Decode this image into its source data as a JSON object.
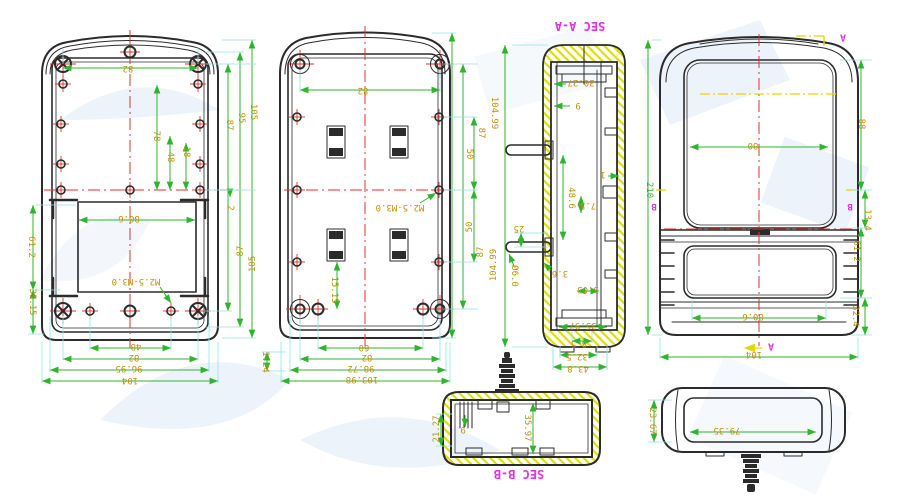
{
  "drawing_type": "enclosure-engineering-drawing",
  "palette": {
    "ink": "#2b2b2b",
    "dim_line": "#2eb42e",
    "dimension_text": "#c2900a",
    "extension": "#93e2e2",
    "centerline": "#e03328",
    "section_label": "#e431e4",
    "hatch": "#e0de00",
    "section_line": "#e8d400",
    "background": "#ffffff",
    "watermark": "#e9f1f9"
  },
  "annotations": [
    {
      "view": "back-panel",
      "text": "82",
      "x": 128,
      "y": 68,
      "rot": 180
    },
    {
      "view": "back-panel",
      "text": "78",
      "x": 156,
      "y": 136,
      "rot": 90
    },
    {
      "view": "back-panel",
      "text": "48",
      "x": 170,
      "y": 157,
      "rot": 90
    },
    {
      "view": "back-panel",
      "text": "18",
      "x": 186,
      "y": 152,
      "rot": 90
    },
    {
      "view": "back-panel",
      "text": "87",
      "x": 229,
      "y": 125,
      "rot": 90
    },
    {
      "view": "back-panel",
      "text": "95",
      "x": 241,
      "y": 118,
      "rot": 90
    },
    {
      "view": "back-panel",
      "text": "105",
      "x": 253,
      "y": 112,
      "rot": 90
    },
    {
      "view": "back-panel",
      "text": "2",
      "x": 230,
      "y": 208,
      "rot": 90
    },
    {
      "view": "back-panel",
      "text": "87",
      "x": 241,
      "y": 251,
      "rot": -90
    },
    {
      "view": "back-panel",
      "text": "105",
      "x": 253,
      "y": 264,
      "rot": -90
    },
    {
      "view": "back-panel",
      "text": "61.2",
      "x": 31,
      "y": 247,
      "rot": 90
    },
    {
      "view": "back-panel",
      "text": "31.15",
      "x": 32,
      "y": 302,
      "rot": 90
    },
    {
      "view": "back-panel",
      "text": "80.6",
      "x": 129,
      "y": 218,
      "rot": 180
    },
    {
      "view": "back-panel",
      "text": "M2.5-M3.0",
      "x": 136,
      "y": 281,
      "rot": 180
    },
    {
      "view": "back-panel",
      "text": "48",
      "x": 136,
      "y": 346,
      "rot": 180
    },
    {
      "view": "back-panel",
      "text": "82",
      "x": 134,
      "y": 357,
      "rot": 180
    },
    {
      "view": "back-panel",
      "text": "96.95",
      "x": 129,
      "y": 368,
      "rot": 180
    },
    {
      "view": "back-panel",
      "text": "104",
      "x": 130,
      "y": 380,
      "rot": 180
    },
    {
      "view": "base-panel",
      "text": "82",
      "x": 363,
      "y": 90,
      "rot": 180
    },
    {
      "view": "base-panel",
      "text": "15.15",
      "x": 334,
      "y": 290,
      "rot": 90
    },
    {
      "view": "base-panel",
      "text": "M2.5-M3.0",
      "x": 400,
      "y": 207,
      "rot": 180
    },
    {
      "view": "base-panel",
      "text": "60",
      "x": 364,
      "y": 347,
      "rot": 180
    },
    {
      "view": "base-panel",
      "text": "82",
      "x": 367,
      "y": 357,
      "rot": 180
    },
    {
      "view": "base-panel",
      "text": "98.72",
      "x": 361,
      "y": 368,
      "rot": 180
    },
    {
      "view": "base-panel",
      "text": "103.98",
      "x": 362,
      "y": 379,
      "rot": 180
    },
    {
      "view": "base-panel",
      "text": "1.24",
      "x": 265,
      "y": 362,
      "rot": 90
    },
    {
      "view": "base-panel",
      "text": "104.99",
      "x": 494,
      "y": 113,
      "rot": 90
    },
    {
      "view": "base-panel",
      "text": "87",
      "x": 481,
      "y": 133,
      "rot": 90
    },
    {
      "view": "base-panel",
      "text": "50",
      "x": 469,
      "y": 154,
      "rot": 90
    },
    {
      "view": "base-panel",
      "text": "50",
      "x": 470,
      "y": 227,
      "rot": -90
    },
    {
      "view": "base-panel",
      "text": "87",
      "x": 481,
      "y": 252,
      "rot": -90
    },
    {
      "view": "base-panel",
      "text": "104.99",
      "x": 494,
      "y": 265,
      "rot": -90
    },
    {
      "view": "section-a-a",
      "text": "SEC A-A",
      "x": 580,
      "y": 26,
      "rot": 180,
      "color": "section_label",
      "size": 12,
      "name": "section-label"
    },
    {
      "view": "section-a-a",
      "text": "30.27",
      "x": 581,
      "y": 82,
      "rot": 180
    },
    {
      "view": "section-a-a",
      "text": "9",
      "x": 578,
      "y": 105,
      "rot": 180
    },
    {
      "view": "section-a-a",
      "text": "1",
      "x": 603,
      "y": 174,
      "rot": 180
    },
    {
      "view": "section-a-a",
      "text": "48.6",
      "x": 571,
      "y": 198,
      "rot": 90
    },
    {
      "view": "section-a-a",
      "text": "7.5",
      "x": 588,
      "y": 205,
      "rot": 180
    },
    {
      "view": "section-a-a",
      "text": "25",
      "x": 519,
      "y": 228,
      "rot": 180
    },
    {
      "view": "section-a-a",
      "text": "Ø6.0",
      "x": 514,
      "y": 276,
      "rot": 90
    },
    {
      "view": "section-a-a",
      "text": "3.6",
      "x": 560,
      "y": 273,
      "rot": 180
    },
    {
      "view": "section-a-a",
      "text": "3.03",
      "x": 588,
      "y": 289,
      "rot": 180
    },
    {
      "view": "section-a-a",
      "text": "35.97",
      "x": 583,
      "y": 325,
      "rot": 180
    },
    {
      "view": "section-a-a",
      "text": "8.5",
      "x": 579,
      "y": 343,
      "rot": 180
    },
    {
      "view": "section-a-a",
      "text": "32.5",
      "x": 577,
      "y": 356,
      "rot": 180
    },
    {
      "view": "section-a-a",
      "text": "43.8",
      "x": 578,
      "y": 368,
      "rot": 180
    },
    {
      "view": "front-view",
      "text": "210",
      "x": 649,
      "y": 190,
      "rot": 90,
      "color": "dim_line"
    },
    {
      "view": "front-view",
      "text": "B",
      "x": 654,
      "y": 206,
      "rot": 180,
      "color": "section_label",
      "size": 9,
      "name": "datum-label"
    },
    {
      "view": "front-view",
      "text": "B",
      "x": 850,
      "y": 206,
      "rot": 180,
      "color": "section_label",
      "size": 9,
      "name": "datum-label"
    },
    {
      "view": "front-view",
      "text": "A",
      "x": 843,
      "y": 37,
      "rot": 180,
      "color": "section_label",
      "size": 10,
      "name": "datum-label"
    },
    {
      "view": "front-view",
      "text": "A",
      "x": 771,
      "y": 346,
      "rot": 180,
      "color": "section_label",
      "size": 10,
      "name": "datum-label"
    },
    {
      "view": "front-view",
      "text": "80",
      "x": 753,
      "y": 145,
      "rot": 180
    },
    {
      "view": "front-view",
      "text": "88",
      "x": 861,
      "y": 124,
      "rot": 90
    },
    {
      "view": "front-view",
      "text": "13.4",
      "x": 867,
      "y": 220,
      "rot": 90
    },
    {
      "view": "front-view",
      "text": "61.2",
      "x": 856,
      "y": 251,
      "rot": 90
    },
    {
      "view": "front-view",
      "text": "32.4",
      "x": 855,
      "y": 316,
      "rot": 90
    },
    {
      "view": "front-view",
      "text": "80.6",
      "x": 753,
      "y": 316,
      "rot": 180
    },
    {
      "view": "front-view",
      "text": "104",
      "x": 754,
      "y": 354,
      "rot": 180
    },
    {
      "view": "section-b-b",
      "text": "SEC B-B",
      "x": 519,
      "y": 474,
      "rot": 180,
      "color": "section_label",
      "size": 12,
      "name": "section-label"
    },
    {
      "view": "section-b-b",
      "text": "21.27",
      "x": 437,
      "y": 429,
      "rot": -90
    },
    {
      "view": "section-b-b",
      "text": "9",
      "x": 463,
      "y": 429,
      "rot": 180
    },
    {
      "view": "section-b-b",
      "text": "35.97",
      "x": 527,
      "y": 428,
      "rot": 90
    },
    {
      "view": "side-view",
      "text": "79.35",
      "x": 727,
      "y": 430,
      "rot": 180
    },
    {
      "view": "side-view",
      "text": "23.67",
      "x": 652,
      "y": 421,
      "rot": 90
    }
  ]
}
